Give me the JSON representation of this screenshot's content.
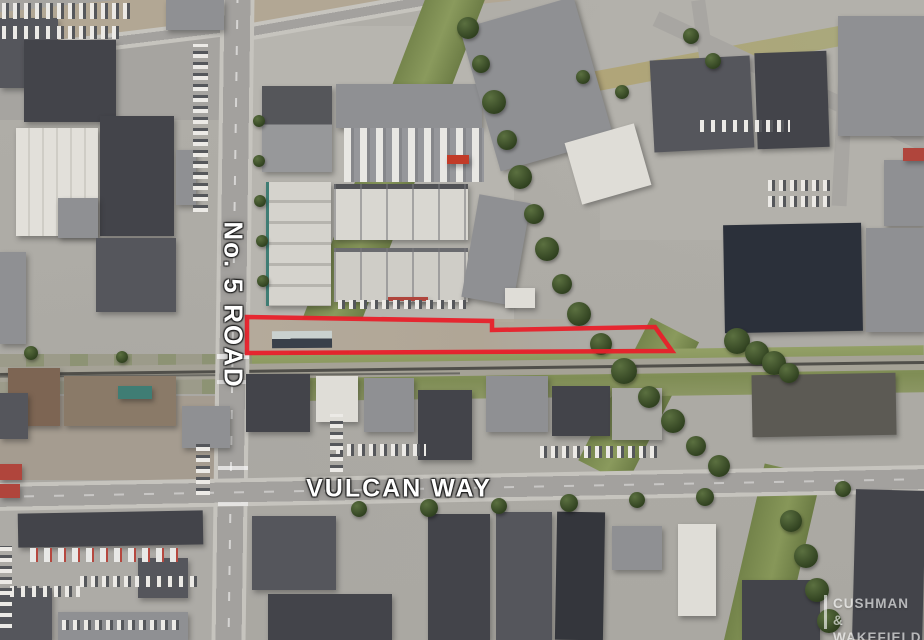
{
  "map": {
    "road_labels": {
      "no5_road": "No. 5 ROAD",
      "vulcan_way": "VULCAN WAY"
    },
    "property_outline": {
      "color": "#e8202a",
      "points": "247,317 492,321 492,330 655,327 672,351 247,353"
    },
    "watermark": {
      "line1": "CUSHMAN &",
      "line2": "WAKEFIELD"
    }
  }
}
